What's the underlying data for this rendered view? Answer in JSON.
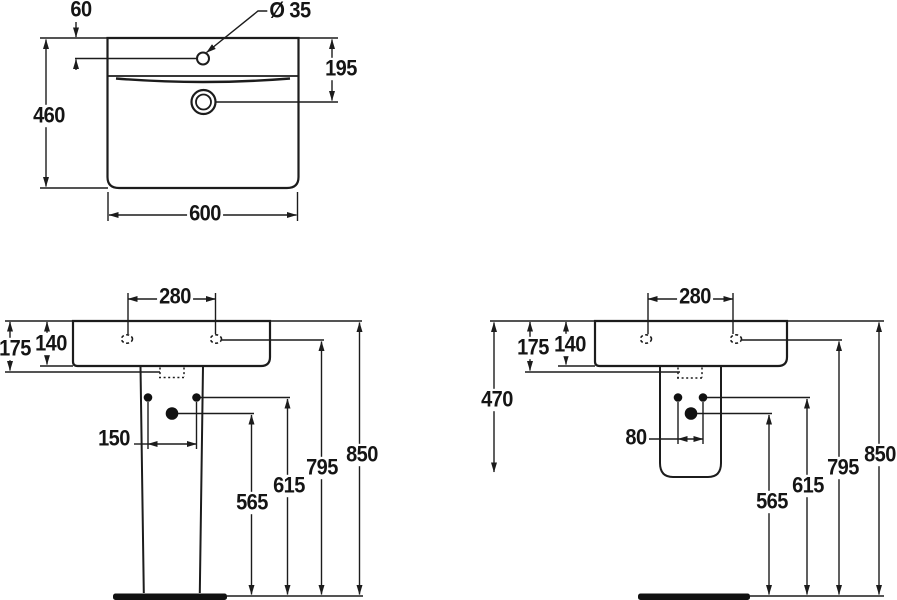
{
  "drawing_title": "washbasin dimension drawing",
  "colors": {
    "line": "#1c1c1c",
    "fill": "#111111",
    "background": "#ffffff"
  },
  "views": {
    "plan": {
      "tap_hole_offset": "60",
      "tap_hole_diameter": "Ø 35",
      "overflow_distance": "195",
      "depth": "460",
      "width": "600"
    },
    "front_pedestal": {
      "tap_hole_spacing": "280",
      "rim_to_underside": "175",
      "rim_thickness": "140",
      "fixing_hole_spacing": "150",
      "waste_height": "565",
      "fixing_height": "615",
      "tap_hole_height": "795",
      "rim_height": "850"
    },
    "front_semi_pedestal": {
      "tap_hole_spacing": "280",
      "rim_to_underside": "175",
      "rim_thickness": "140",
      "semi_pedestal_height": "470",
      "fixing_hole_spacing": "80",
      "waste_height": "565",
      "fixing_height": "615",
      "tap_hole_height": "795",
      "rim_height": "850"
    }
  }
}
